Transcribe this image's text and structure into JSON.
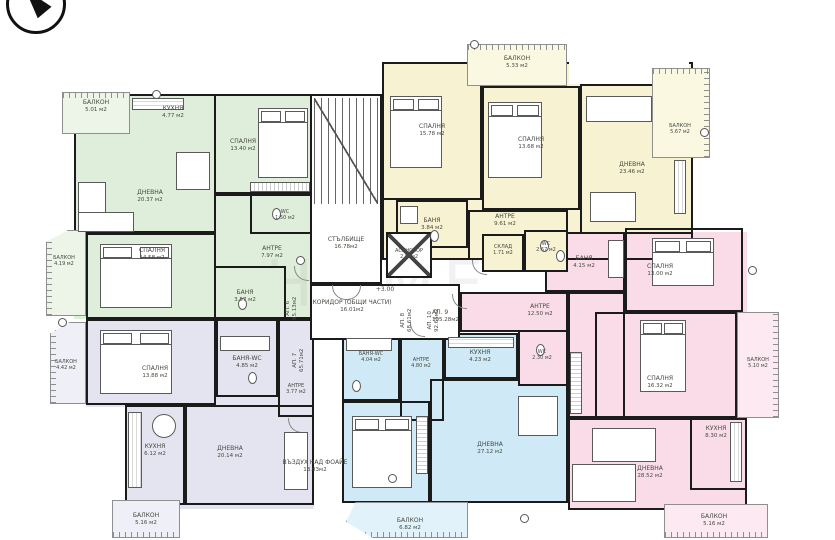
{
  "meta": {
    "level_marker": "+3.00",
    "watermark": "HOME"
  },
  "colors": {
    "wall": "#1b1b1b",
    "green": "#dfeeda",
    "green_balcony": "#ecf5e8",
    "yellow": "#f7f3d2",
    "yellow_balcony": "#fbf8e2",
    "pink": "#fadce9",
    "pink_balcony": "#fce9f2",
    "blue": "#cfe9f6",
    "blue_balcony": "#e2f2fb",
    "lavender": "#e4e4f1",
    "lavender_balcony": "#efeff7"
  },
  "common_areas": {
    "staircase": {
      "name": "СТЪЛБИЩЕ",
      "area": "16.78м2"
    },
    "elevator": {
      "name": "АСАНСЬОР",
      "area": "2.88м2"
    },
    "corridor": {
      "name": "КОРИДОР (ОБЩИ ЧАСТИ)",
      "area": "16.01м2"
    },
    "void_above_foyer": {
      "name": "ВЪЗДУХ НАД ФОАЙЕ",
      "area": "13.83м2"
    }
  },
  "apartments": [
    {
      "id": "АП. 6",
      "total_area": "85.13м2",
      "color_key": "green",
      "rooms": [
        {
          "name": "БАЛКОН",
          "area": "5.01 м2"
        },
        {
          "name": "КУХНЯ",
          "area": "4.77 м2"
        },
        {
          "name": "СПАЛНЯ",
          "area": "13.40 м2"
        },
        {
          "name": "ДНЕВНА",
          "area": "20.37 м2"
        },
        {
          "name": "СПАЛНЯ",
          "area": "14.58 м2"
        },
        {
          "name": "АНТРЕ",
          "area": "7.97 м2"
        },
        {
          "name": "БАНЯ",
          "area": "3.57 м2"
        },
        {
          "name": "WC",
          "area": "1.50 м2"
        },
        {
          "name": "БАЛКОН",
          "area": "4.19 м2"
        }
      ]
    },
    {
      "id": "АП. 7",
      "total_area": "65.71м2",
      "color_key": "lavender",
      "rooms": [
        {
          "name": "СПАЛНЯ",
          "area": "13.88 м2"
        },
        {
          "name": "БАНЯ-WC",
          "area": "4.85 м2"
        },
        {
          "name": "АНТРЕ",
          "area": "3.77 м2"
        },
        {
          "name": "КУХНЯ",
          "area": "6.12 м2"
        },
        {
          "name": "ДНЕВНА",
          "area": "20.14 м2"
        },
        {
          "name": "БАЛКОН",
          "area": "5.16 м2"
        },
        {
          "name": "БАЛКОН",
          "area": "4.42 м2"
        }
      ]
    },
    {
      "id": "АП. 10",
      "total_area": "92.65м2",
      "color_key": "yellow",
      "rooms": [
        {
          "name": "БАЛКОН",
          "area": "5.33 м2"
        },
        {
          "name": "СПАЛНЯ",
          "area": "15.78 м2"
        },
        {
          "name": "СПАЛНЯ",
          "area": "13.68 м2"
        },
        {
          "name": "ДНЕВНА",
          "area": "23.46 м2"
        },
        {
          "name": "БАНЯ",
          "area": "3.84 м2"
        },
        {
          "name": "АНТРЕ",
          "area": "9.61 м2"
        },
        {
          "name": "СКЛАД",
          "area": "1.71 м2"
        },
        {
          "name": "WC",
          "area": "2.67 м2"
        },
        {
          "name": "БАЛКОН",
          "area": "5.67 м2"
        }
      ]
    },
    {
      "id": "АП. 9",
      "total_area": "105.28м2",
      "color_key": "pink",
      "rooms": [
        {
          "name": "БАНЯ",
          "area": "4.15 м2"
        },
        {
          "name": "СПАЛНЯ",
          "area": "13.00 м2"
        },
        {
          "name": "АНТРЕ",
          "area": "12.50 м2"
        },
        {
          "name": "WC",
          "area": "2.30 м2"
        },
        {
          "name": "СПАЛНЯ",
          "area": "16.32 м2"
        },
        {
          "name": "БАЛКОН",
          "area": "5.10 м2"
        },
        {
          "name": "КУХНЯ",
          "area": "8.30 м2"
        },
        {
          "name": "ДНЕВНА",
          "area": "28.52 м2"
        },
        {
          "name": "БАЛКОН",
          "area": "5.16 м2"
        }
      ]
    },
    {
      "id": "АП. 8",
      "total_area": "68.61м2",
      "color_key": "blue",
      "rooms": [
        {
          "name": "БАНЯ-WC",
          "area": "4.04 м2"
        },
        {
          "name": "АНТРЕ",
          "area": "4.80 м2"
        },
        {
          "name": "КУХНЯ",
          "area": "4.23 м2"
        },
        {
          "name": "ДНЕВНА",
          "area": "27.12 м2"
        },
        {
          "name": "БАЛКОН",
          "area": "6.82 м2"
        }
      ]
    }
  ]
}
